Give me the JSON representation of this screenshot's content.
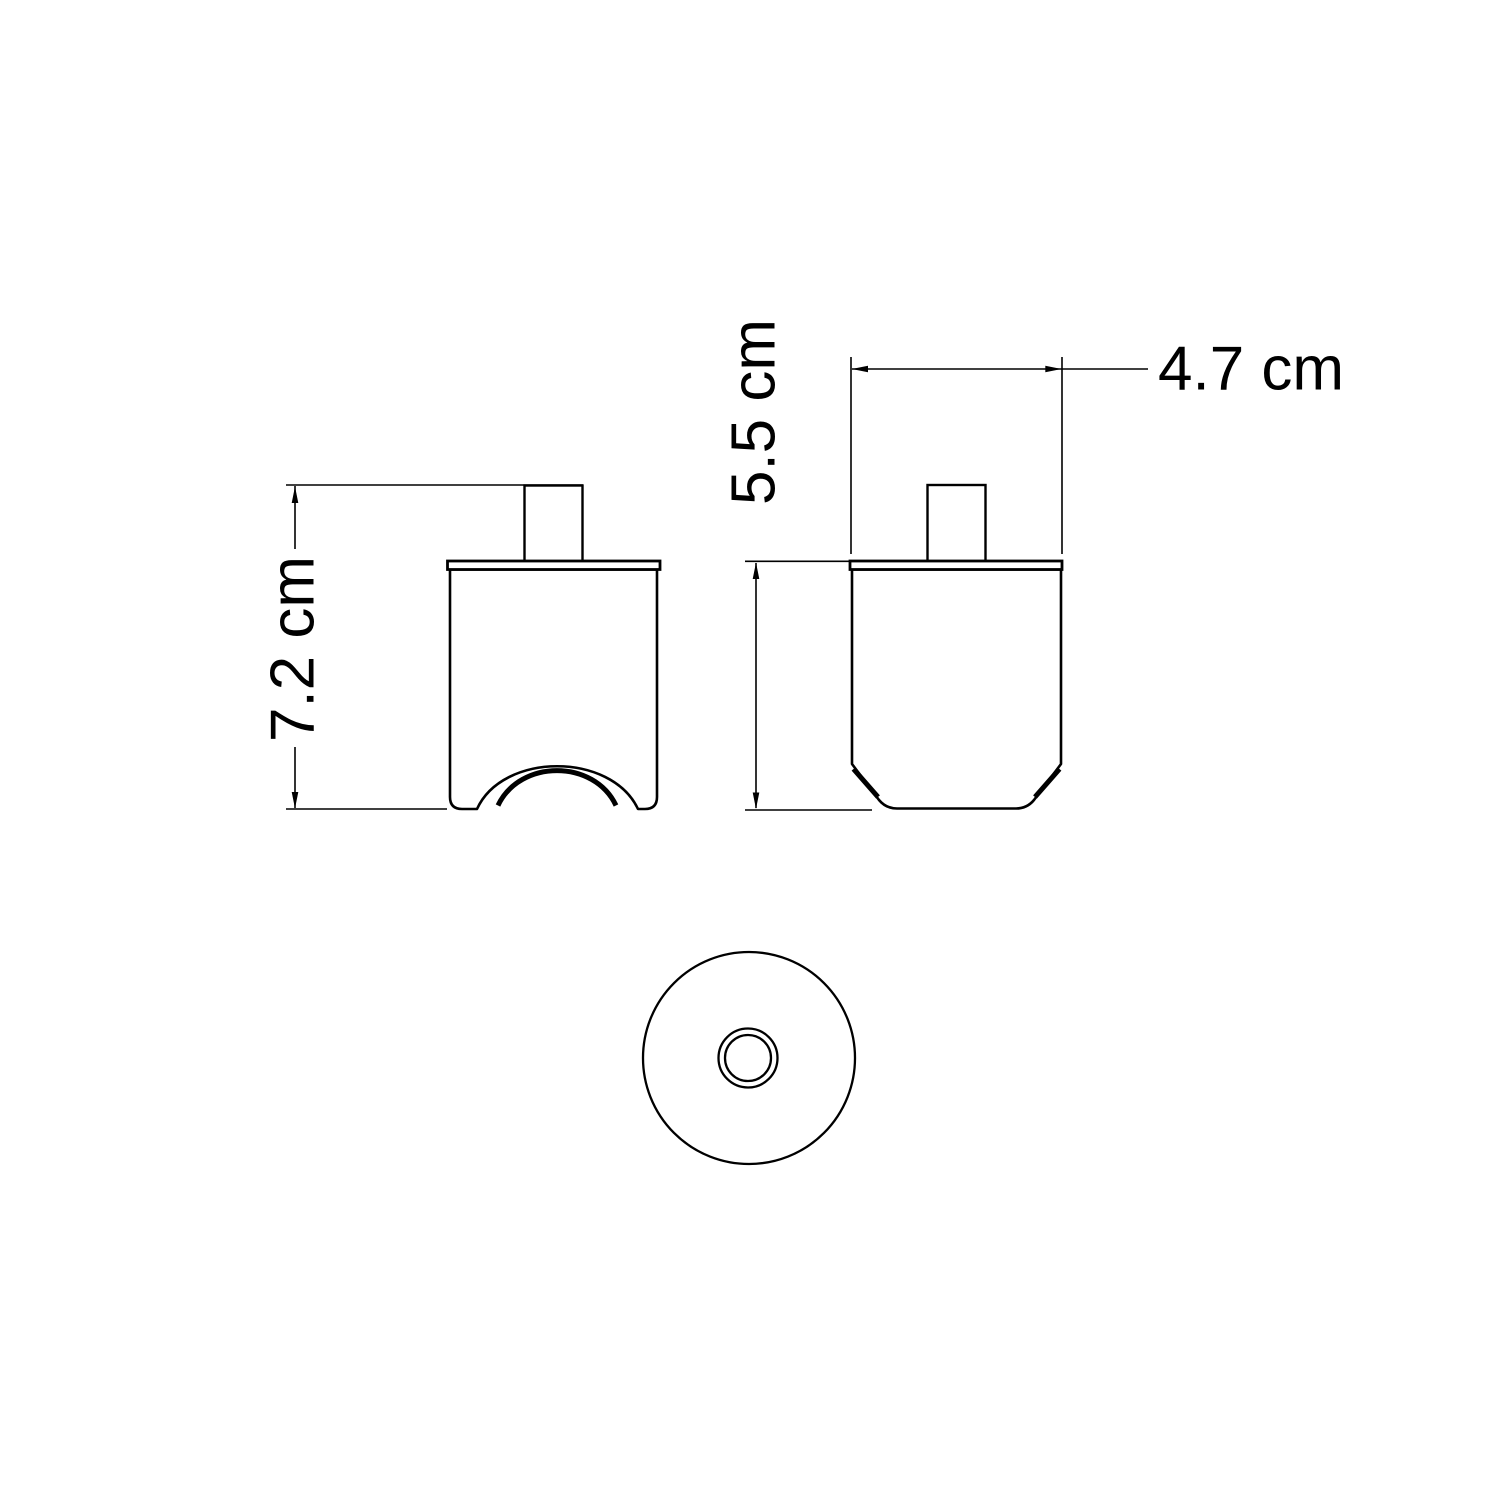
{
  "drawing": {
    "dim_total_height": "7.2 cm",
    "dim_body_height": "5.5 cm",
    "dim_width": "4.7 cm"
  },
  "colors": {
    "line": "#000000",
    "background": "#ffffff"
  }
}
